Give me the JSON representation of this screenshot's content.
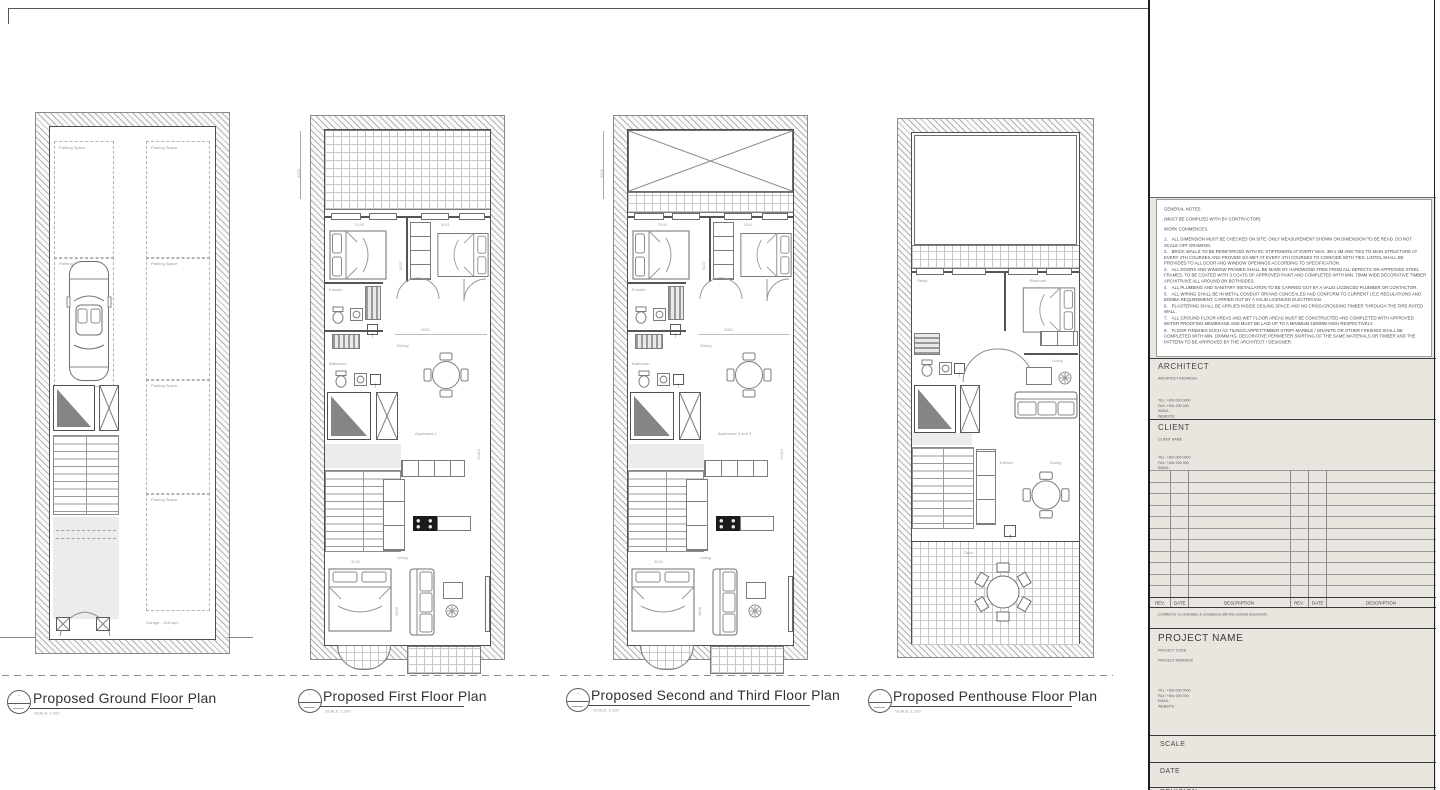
{
  "titles": {
    "ground": "Proposed Ground Floor Plan",
    "first": "Proposed First Floor Plan",
    "second_third": "Proposed Second and Third Floor Plan",
    "penthouse": "Proposed Penthouse Floor Plan",
    "scale_note": "SCALE: 1:100",
    "bubble_dash": "-"
  },
  "plan_labels": {
    "parking_space": "Parking Space",
    "garage": "Garage - 108 sqm",
    "ensuite": "Ensuite",
    "bathroom": "Bathroom",
    "dining": "Dining",
    "living": "Living",
    "apartment1": "Apartment 1",
    "apartment23": "Apartment 2 and 3",
    "study": "Study",
    "bedroom": "Bedroom",
    "kitchen": "Kitchen",
    "deck": "Deck"
  },
  "dimensions": {
    "d3000": "3000",
    "d3140": "3140",
    "d3011": "3011",
    "d5137": "5137",
    "d4061": "4061",
    "d13410": "13410",
    "d3032": "3032",
    "d3800": "3800"
  },
  "icons": {
    "up_arrow": "↑"
  },
  "title_block": {
    "general_notes_title": "GENERAL NOTES",
    "general_notes_sub": "(MUST BE COMPLIED WITH BY CONTRACTOR)",
    "general_notes_sub2": "WORK COMMENCES.",
    "notes": [
      {
        "n": "1.",
        "text": "ALL DIMENSION MUST BE CHECKED ON SITE. ONLY MEASUREMENT SHOWN ON DIMENSION TO BE READ. DO NOT SCALE OFF DRAWING."
      },
      {
        "n": "2.",
        "text": "BRICK WALLS TO BE REINFORCED WITH RC STIFFENERS AT EVERY MAX. 3M x 3M AND TIES TO MAIN STRUCTURE AT EVERY 4TH COURSES AND PROVIDE EX-MET AT EVERY 4TH COURSES TO COINCIDE WITH TIES. LINTOL SHALL BE PROVIDED TO ALL DOOR AND WINDOW OPENINGS ACCORDING TO SPECIFICATION."
      },
      {
        "n": "3.",
        "text": "ALL DOORS AND WINDOW FRAMES SHALL BE MADE BY HARDWOOD FREE FROM ALL DEFECTS OR APPROVED STEEL FRAMES, TO BE COATED WITH 3 COATS OF APPROVED PAINT AND COMPLETED WITH MIN. 75MM WIDE DECORATIVE TIMBER ARCHITRAVE ALL AROUND ON BOTHSIDES."
      },
      {
        "n": "4.",
        "text": "ALL PLUMBING AND SANITARY INSTALLATION TO BE CARRIED OUT BY A VALID LICENCED PLUMBER OR CONTACTOR."
      },
      {
        "n": "5.",
        "text": "ALL WIRING SHALL BE IN METAL CONDUIT OR/AND CONCEALED AND CONFORM TO CURRENT I.E.E REGULATIONS AND BOMBA REQUIREMENT, CARRIED OUT BY A VALID LICENCED ELECTRICIAN."
      },
      {
        "n": "6.",
        "text": "PLASTERING SHALL BE APPLIED INSIDE CEILING SPACE AND NO CRISS-CROSSING TIMBER THROUGH THE FIRE-RATED WALL."
      },
      {
        "n": "7.",
        "text": "ALL GROUND FLOOR AREAS AND WET FLOOR AREAS MUST BE CONSTRUCTED AND COMPLETED WITH APPROVED WATER PROOFING MEMBRANE AND MUST BE LAID UP TO A MINIMUM 1500MM HIGH RESPECTIVELY."
      },
      {
        "n": "8.",
        "text": "FLOOR FINISHES SUCH AS TILING/CARPET/TIMBER STRIP/ MARBLE / GRANITE OR OTHER FINISHES SHALL BE COMPLETED WITH MIN. 100MM HG. DECORATIVE PERIMETER SKIRTING OF THE SAME MATERIALS OR TIMBER AND THE PATTERN TO BE APPROVED BY THE ARCHITECT / DESIGNER."
      }
    ],
    "architect": {
      "title": "ARCHITECT",
      "address": "ARCHITECT ADDRESS",
      "tel": "TEL: +60x 000 0000",
      "fax": "FAX: +60x 000 000",
      "email": "EMAIL:",
      "website": "WEBSITE:"
    },
    "client": {
      "title": "CLIENT",
      "name": "CLIENT NAME",
      "tel": "TEL: +60x 000 0000",
      "fax": "FAX: +60x 000 000",
      "email": "EMAIL:"
    },
    "rev_table": {
      "rev": "REV.",
      "date": "DATE",
      "description": "DESCRIPTION"
    },
    "certified": "Certified for co-ordination & compliance with the contract documents.",
    "project": {
      "title": "PROJECT NAME",
      "code": "PROJECT CODE",
      "address": "PROJECT ADDRESS",
      "tel": "TEL: +60x 000 0000",
      "fax": "FAX: +60x 000 000",
      "email": "EMAIL:",
      "website": "WEBSITE:"
    },
    "scale": "SCALE",
    "date": "DATE",
    "revision": "REVISION"
  }
}
